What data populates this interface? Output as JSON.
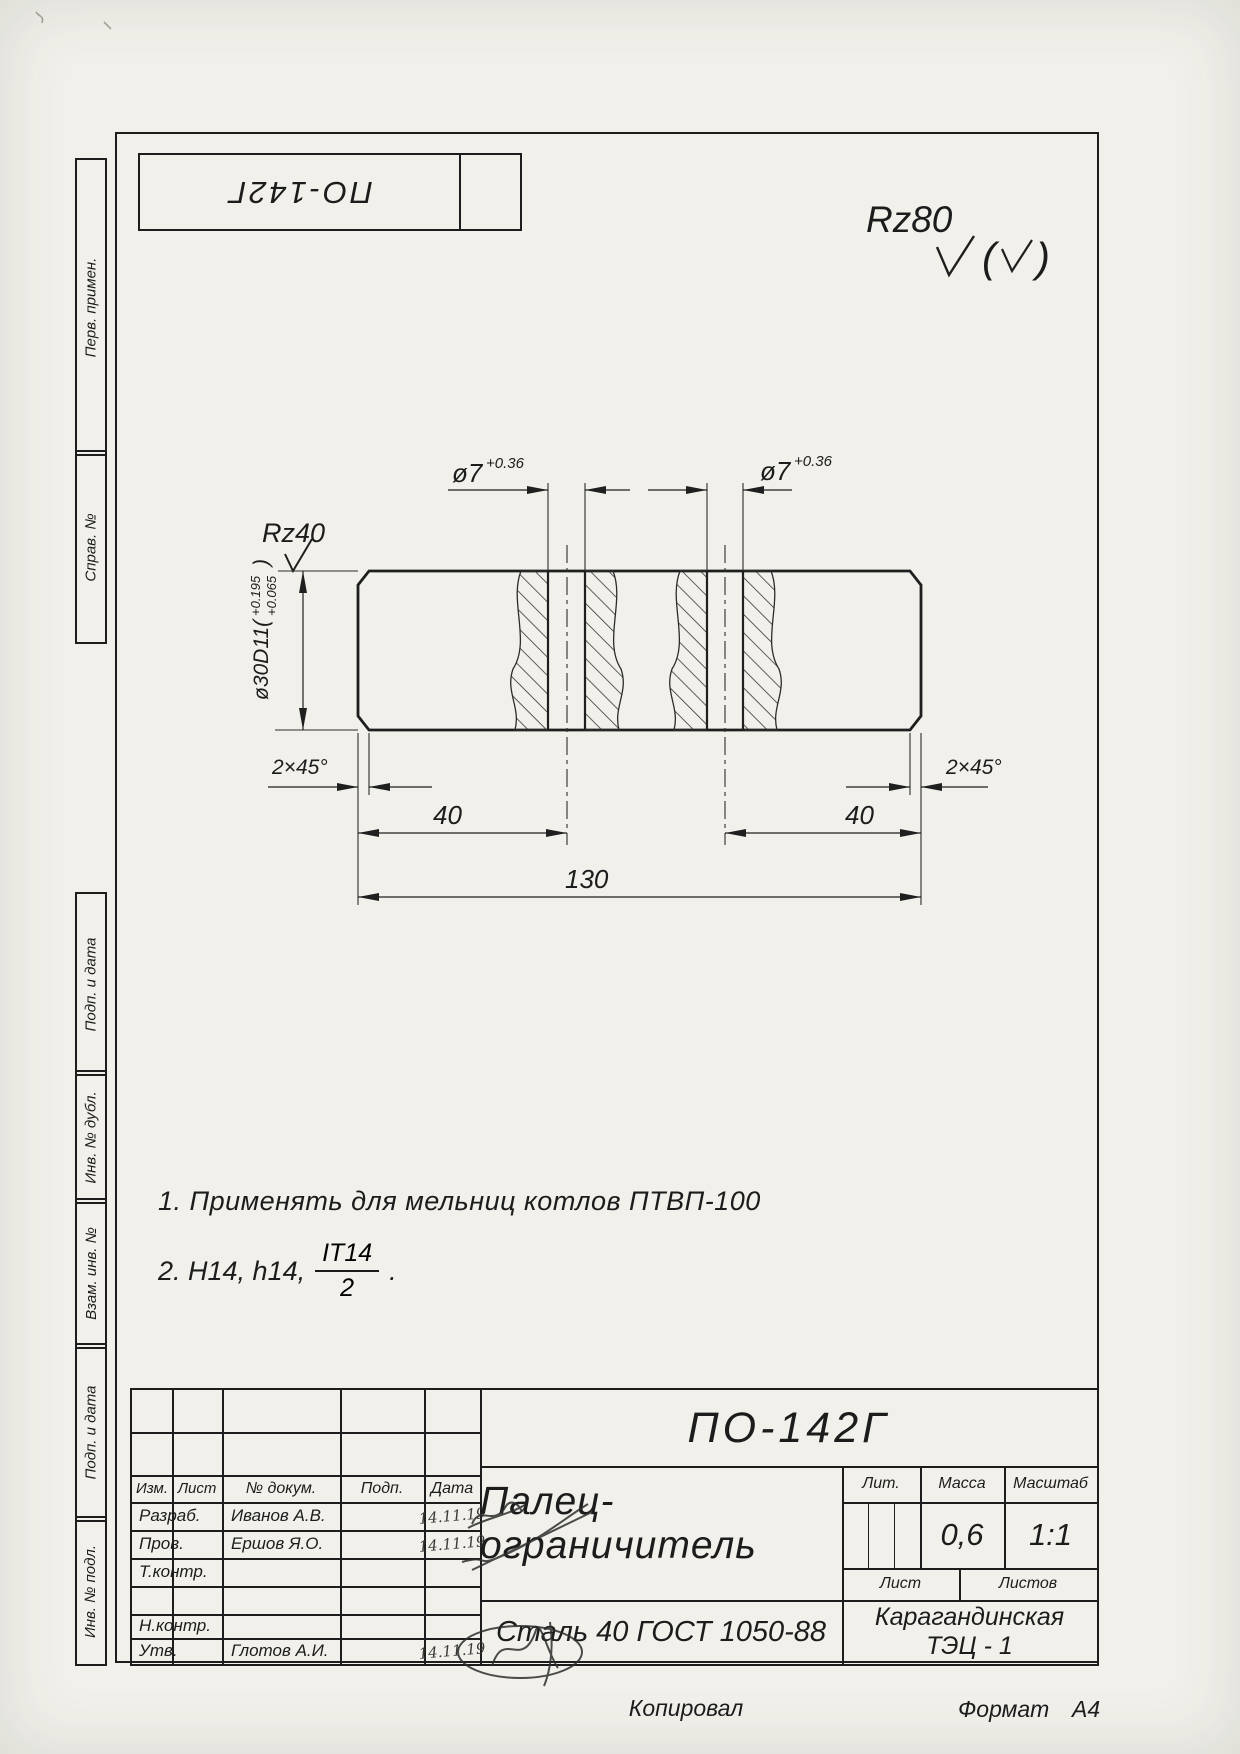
{
  "top_stamp": {
    "designation": "ПО-142Г"
  },
  "roughness": {
    "general_mark": "Rz80",
    "paren_open": "(",
    "paren_close": ")",
    "local_mark": "Rz40"
  },
  "side_top": [
    {
      "label": "Перв. примен."
    },
    {
      "label": "Справ. №"
    }
  ],
  "side_bottom": [
    {
      "label": "Подп. и дата"
    },
    {
      "label": "Инв. № дубл."
    },
    {
      "label": "Взам. инв. №"
    },
    {
      "label": "Подп. и дата"
    },
    {
      "label": "Инв. № подл."
    }
  ],
  "dims": {
    "hole_dia": "ø7",
    "hole_tol": "+0.36",
    "outer_prefix": "ø30D11(",
    "outer_tol_upper": "+0.195",
    "outer_tol_lower": "+0.065",
    "outer_suffix": ")",
    "chamfer": "2×45°",
    "len_left": "40",
    "len_right": "40",
    "len_total": "130"
  },
  "notes": {
    "line1": "1. Применять для мельниц котлов ПТВП-100",
    "line2_prefix": "2. Н14, h14,",
    "frac_num": "IT14",
    "frac_den": "2",
    "line2_suffix": "."
  },
  "title_block": {
    "designation": "ПО-142Г",
    "part_name": "Палец-ограничитель",
    "material": "Сталь 40  ГОСТ 1050-88",
    "org_line1": "Карагандинская",
    "org_line2": "ТЭЦ - 1",
    "mass_value": "0,6",
    "scale_value": "1:1",
    "headers": {
      "izm": "Изм.",
      "list": "Лист",
      "doc": "№ докум.",
      "podp": "Подп.",
      "data": "Дата",
      "lit": "Лит.",
      "massa": "Масса",
      "masshtab": "Масштаб",
      "list2": "Лист",
      "listov": "Листов"
    },
    "rows": [
      {
        "role": "Разраб.",
        "name": "Иванов А.В.",
        "date": "14.11.19"
      },
      {
        "role": "Пров.",
        "name": "Ершов Я.О.",
        "date": "14.11.19"
      },
      {
        "role": "Т.контр.",
        "name": "",
        "date": ""
      },
      {
        "role": "",
        "name": "",
        "date": ""
      },
      {
        "role": "Н.контр.",
        "name": "",
        "date": ""
      },
      {
        "role": "Утв.",
        "name": "Глотов А.И.",
        "date": "14.11.19"
      }
    ]
  },
  "footer": {
    "copied": "Копировал",
    "format_label": "Формат",
    "format_value": "А4"
  }
}
